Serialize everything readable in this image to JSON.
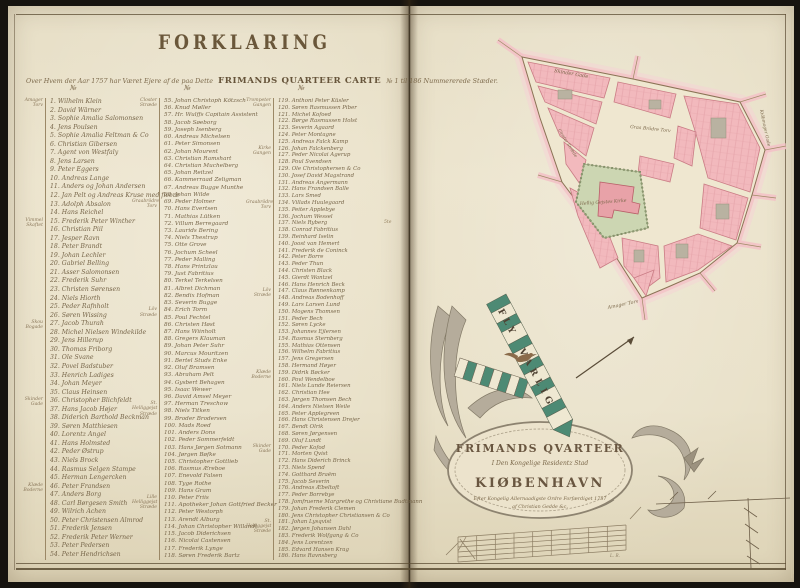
{
  "page": {
    "title": "FORKLARING",
    "subtitle_pre": "Over Hvem der Aar 1757 har Været Ejere af de paa Dette",
    "subtitle_caps": "FRIMANDS QUARTEER CARTE",
    "subtitle_post": "№ 1 til 186 Nummererede Stæder.",
    "gutter_note": "5te"
  },
  "legend": {
    "col_header": "№",
    "columns": [
      {
        "groups": [
          {
            "label": "Amager Torv",
            "start": 1
          },
          {
            "label": "Vimmel Skaftet",
            "start": 15
          },
          {
            "label": "Skou Bogade",
            "start": 27
          },
          {
            "label": "Skinder Gade",
            "start": 36
          },
          {
            "label": "Klæde Boderne",
            "start": 46
          }
        ],
        "entries": [
          {
            "no": 1,
            "name": "Wilhelm Klein"
          },
          {
            "no": 2,
            "name": "David Wärner"
          },
          {
            "no": 3,
            "name": "Sophie Amalia Salomonsen"
          },
          {
            "no": 4,
            "name": "Jens Poulsen"
          },
          {
            "no": 5,
            "name": "Sophie Amalia Feltman & Co"
          },
          {
            "no": 6,
            "name": "Christian Gibersen"
          },
          {
            "no": 7,
            "name": "Agent von Westfaly"
          },
          {
            "no": 8,
            "name": "Jens Larsen"
          },
          {
            "no": 9,
            "name": "Peter Eggers"
          },
          {
            "no": 10,
            "name": "Andreas Lange"
          },
          {
            "no": 11,
            "name": "Anders og Johan Andersen"
          },
          {
            "no": 12,
            "name": "Jan Pelt og Andreas Kruse med fleere"
          },
          {
            "no": 13,
            "name": "Adolph Absalon"
          },
          {
            "no": 14,
            "name": "Hans Reichel"
          },
          {
            "no": 15,
            "name": "Frederik Peter Winther"
          },
          {
            "no": 16,
            "name": "Christian Piil"
          },
          {
            "no": 17,
            "name": "Jesper Ravn"
          },
          {
            "no": 18,
            "name": "Peter Brandt"
          },
          {
            "no": 19,
            "name": "Johan Lechler"
          },
          {
            "no": 20,
            "name": "Gabriel Belling"
          },
          {
            "no": 21,
            "name": "Asser Salomonsen"
          },
          {
            "no": 22,
            "name": "Frederik Suhr"
          },
          {
            "no": 23,
            "name": "Christen Sørensen"
          },
          {
            "no": 24,
            "name": "Niels Hiorth"
          },
          {
            "no": 25,
            "name": "Peder Rafnholt"
          },
          {
            "no": 26,
            "name": "Søren Wissing"
          },
          {
            "no": 27,
            "name": "Jacob Thurah"
          },
          {
            "no": 28,
            "name": "Michel Nielsen Windekilde"
          },
          {
            "no": 29,
            "name": "Jens Hillerup"
          },
          {
            "no": 30,
            "name": "Thomas Friborg"
          },
          {
            "no": 31,
            "name": "Ole Svane"
          },
          {
            "no": 32,
            "name": "Povel Badstuber"
          },
          {
            "no": 33,
            "name": "Henrich Ladiges"
          },
          {
            "no": 34,
            "name": "Johan Meyer"
          },
          {
            "no": 35,
            "name": "Claus Heinsen"
          },
          {
            "no": 36,
            "name": "Christopher Blichfeldt"
          },
          {
            "no": 37,
            "name": "Hans Jacob Højer"
          },
          {
            "no": 38,
            "name": "Diderich Barthold Beckman"
          },
          {
            "no": 39,
            "name": "Søren Matthiesen"
          },
          {
            "no": 40,
            "name": "Lorentz Angel"
          },
          {
            "no": 41,
            "name": "Hans Holmsted"
          },
          {
            "no": 42,
            "name": "Peder Østrup"
          },
          {
            "no": 43,
            "name": "Niels Brock"
          },
          {
            "no": 44,
            "name": "Rasmus Selgen Stampe"
          },
          {
            "no": 45,
            "name": "Herman Lengercken"
          },
          {
            "no": 46,
            "name": "Peter Frandsen"
          },
          {
            "no": 47,
            "name": "Anders Borg"
          },
          {
            "no": 48,
            "name": "Carl Børgesen Smith"
          },
          {
            "no": 49,
            "name": "Wilrich Achen"
          },
          {
            "no": 50,
            "name": "Peter Christensen Almrod"
          },
          {
            "no": 51,
            "name": "Frederik Jensen"
          },
          {
            "no": 52,
            "name": "Frederik Peter Werner"
          },
          {
            "no": 53,
            "name": "Peter Pedersen"
          },
          {
            "no": 54,
            "name": "Peter Hendrichsen"
          }
        ]
      },
      {
        "groups": [
          {
            "label": "Closter Stræde",
            "start": 55
          },
          {
            "label": "Graabrödre Torv",
            "start": 69
          },
          {
            "label": "Löv Stræde",
            "start": 84
          },
          {
            "label": "St. Helliggejst Stræde",
            "start": 97
          },
          {
            "label": "Lille Helliggejst Stræde",
            "start": 110
          }
        ],
        "entries": [
          {
            "no": 55,
            "name": "Johan Christoph Kötzsch"
          },
          {
            "no": 56,
            "name": "Knud Møller"
          },
          {
            "no": 57,
            "name": "Hr. Wulffs Capitain Assistent"
          },
          {
            "no": 58,
            "name": "Jacob Søeborg"
          },
          {
            "no": 59,
            "name": "Joseph Isenberg"
          },
          {
            "no": 60,
            "name": "Andreas Michelsen"
          },
          {
            "no": 61,
            "name": "Peter Simonsen"
          },
          {
            "no": 62,
            "name": "Johan Mourent"
          },
          {
            "no": 63,
            "name": "Christian Ramshart"
          },
          {
            "no": 64,
            "name": "Christian Muchelberg"
          },
          {
            "no": 65,
            "name": "Johan Reitzel"
          },
          {
            "no": 66,
            "name": "Kammerraad Zeligman"
          },
          {
            "no": 67,
            "name": "Andreas Bugge Munthe"
          },
          {
            "no": 68,
            "name": "Johan Wilde"
          },
          {
            "no": 69,
            "name": "Peder Holmer"
          },
          {
            "no": 70,
            "name": "Hans Evertsen"
          },
          {
            "no": 71,
            "name": "Mathias Lütken"
          },
          {
            "no": 72,
            "name": "Villum Berregaard"
          },
          {
            "no": 73,
            "name": "Laurids Bering"
          },
          {
            "no": 74,
            "name": "Niels Thestrup"
          },
          {
            "no": 75,
            "name": "Otte Grove"
          },
          {
            "no": 76,
            "name": "Jochum Scheel"
          },
          {
            "no": 77,
            "name": "Peder Malling"
          },
          {
            "no": 78,
            "name": "Hans Printzlau"
          },
          {
            "no": 79,
            "name": "Just Fabritius"
          },
          {
            "no": 80,
            "name": "Terkel Terkelsen"
          },
          {
            "no": 81,
            "name": "Albret Dichman"
          },
          {
            "no": 82,
            "name": "Bendix Hofman"
          },
          {
            "no": 83,
            "name": "Severin Bugge"
          },
          {
            "no": 84,
            "name": "Erich Torm"
          },
          {
            "no": 85,
            "name": "Poul Fechtel"
          },
          {
            "no": 86,
            "name": "Christen Høst"
          },
          {
            "no": 87,
            "name": "Hans Wiinholt"
          },
          {
            "no": 88,
            "name": "Gregers Klauman"
          },
          {
            "no": 89,
            "name": "Johan Peter Suhr"
          },
          {
            "no": 90,
            "name": "Marcus Mouritzen"
          },
          {
            "no": 91,
            "name": "Bertel Studs Enke"
          },
          {
            "no": 92,
            "name": "Oluf Bramsen"
          },
          {
            "no": 93,
            "name": "Abraham Pelt"
          },
          {
            "no": 94,
            "name": "Gysbert Behagen"
          },
          {
            "no": 95,
            "name": "Isaac Wewer"
          },
          {
            "no": 96,
            "name": "David Amsel Meyer"
          },
          {
            "no": 97,
            "name": "Herman Treschow"
          },
          {
            "no": 98,
            "name": "Niels Titken"
          },
          {
            "no": 99,
            "name": "Broder Brodersen"
          },
          {
            "no": 100,
            "name": "Mads Roed"
          },
          {
            "no": 101,
            "name": "Anders Dons"
          },
          {
            "no": 102,
            "name": "Peder Sommerfeldt"
          },
          {
            "no": 103,
            "name": "Hans Jørgen Sotmann"
          },
          {
            "no": 104,
            "name": "Jørgen Bøfke"
          },
          {
            "no": 105,
            "name": "Christopher Gottlieb"
          },
          {
            "no": 106,
            "name": "Rasmus Æreboe"
          },
          {
            "no": 107,
            "name": "Enevold Falsen"
          },
          {
            "no": 108,
            "name": "Tyge Rothe"
          },
          {
            "no": 109,
            "name": "Hans Gram"
          },
          {
            "no": 110,
            "name": "Peter Friis"
          },
          {
            "no": 111,
            "name": "Apotheker Johan Gottfried Becker"
          },
          {
            "no": 112,
            "name": "Peter Westorph"
          },
          {
            "no": 113,
            "name": "Arendt Alburg"
          },
          {
            "no": 114,
            "name": "Johan Christopher Willandt"
          },
          {
            "no": 115,
            "name": "Jacob Diderichsen"
          },
          {
            "no": 116,
            "name": "Nicolai Castensen"
          },
          {
            "no": 117,
            "name": "Frederik Lynge"
          },
          {
            "no": 118,
            "name": "Søren Frederik Bartz"
          }
        ]
      },
      {
        "groups": [
          {
            "label": "Trompeter Gangen",
            "start": 119
          },
          {
            "label": "Kirke Gangen",
            "start": 126
          },
          {
            "label": "Graabrödre Torv",
            "start": 134
          },
          {
            "label": "Löv Stræde",
            "start": 147
          },
          {
            "label": "Klæde Boderne",
            "start": 159
          },
          {
            "label": "Skinder Gade",
            "start": 170
          },
          {
            "label": "St. Helliggejst Stræde",
            "start": 181
          }
        ],
        "entries": [
          {
            "no": 119,
            "name": "Anthoni Peter Küsler"
          },
          {
            "no": 120,
            "name": "Søren Rasmussen Piber"
          },
          {
            "no": 121,
            "name": "Michel Kofoed"
          },
          {
            "no": 122,
            "name": "Børge Rasmussen Holst"
          },
          {
            "no": 123,
            "name": "Severin Agaard"
          },
          {
            "no": 124,
            "name": "Peter Montagne"
          },
          {
            "no": 125,
            "name": "Andreas Falck Kamp"
          },
          {
            "no": 126,
            "name": "Johan Falckenberg"
          },
          {
            "no": 127,
            "name": "Peder Nicolai Agerup"
          },
          {
            "no": 128,
            "name": "Poul Svendsen"
          },
          {
            "no": 129,
            "name": "Ole Christophersen & Co"
          },
          {
            "no": 130,
            "name": "Josef David Magstrand"
          },
          {
            "no": 131,
            "name": "Andreas Angermann"
          },
          {
            "no": 132,
            "name": "Hans Frandsen Balle"
          },
          {
            "no": 133,
            "name": "Lars Smed"
          },
          {
            "no": 134,
            "name": "Villads Huulegaard"
          },
          {
            "no": 135,
            "name": "Peiter Applebye"
          },
          {
            "no": 136,
            "name": "Jochum Wessel"
          },
          {
            "no": 137,
            "name": "Niels Ryberg"
          },
          {
            "no": 138,
            "name": "Conrad Fabritius"
          },
          {
            "no": 139,
            "name": "Reinhard Iselin"
          },
          {
            "no": 140,
            "name": "Joost van Hemert"
          },
          {
            "no": 141,
            "name": "Frederik de Coninck"
          },
          {
            "no": 142,
            "name": "Peter Borre"
          },
          {
            "no": 143,
            "name": "Peder Thun"
          },
          {
            "no": 144,
            "name": "Christen Black"
          },
          {
            "no": 145,
            "name": "Gierdt Wantzel"
          },
          {
            "no": 146,
            "name": "Hans Henrich Beck"
          },
          {
            "no": 147,
            "name": "Claus Rønnenkamp"
          },
          {
            "no": 148,
            "name": "Andreas Bodenhoff"
          },
          {
            "no": 149,
            "name": "Lars Larsen Lund"
          },
          {
            "no": 150,
            "name": "Mogens Thomsen"
          },
          {
            "no": 151,
            "name": "Peder Bech"
          },
          {
            "no": 152,
            "name": "Søren Lycke"
          },
          {
            "no": 153,
            "name": "Johannes Ejlersen"
          },
          {
            "no": 154,
            "name": "Rasmus Sternberg"
          },
          {
            "no": 155,
            "name": "Mathias Ottensen"
          },
          {
            "no": 156,
            "name": "Wilhelm Fabritius"
          },
          {
            "no": 157,
            "name": "Jens Gregersen"
          },
          {
            "no": 158,
            "name": "Hermand Høyer"
          },
          {
            "no": 159,
            "name": "Didrik Bøcker"
          },
          {
            "no": 160,
            "name": "Povl Wendelboe"
          },
          {
            "no": 161,
            "name": "Niels Lunde Reiersen"
          },
          {
            "no": 162,
            "name": "Christian Hee"
          },
          {
            "no": 163,
            "name": "Jørgen Thomsen Bech"
          },
          {
            "no": 164,
            "name": "Anders Nielsen Weile"
          },
          {
            "no": 165,
            "name": "Peter Applegreen"
          },
          {
            "no": 166,
            "name": "Hans Christensen Drejer"
          },
          {
            "no": 167,
            "name": "Bendt Olrik"
          },
          {
            "no": 168,
            "name": "Søren Jørgensen"
          },
          {
            "no": 169,
            "name": "Oluf Lundt"
          },
          {
            "no": 170,
            "name": "Peder Kofod"
          },
          {
            "no": 171,
            "name": "Morten Qvist"
          },
          {
            "no": 172,
            "name": "Hans Diderich Brinck"
          },
          {
            "no": 173,
            "name": "Niels Spend"
          },
          {
            "no": 174,
            "name": "Gotthard Braëm"
          },
          {
            "no": 175,
            "name": "Jacob Severin"
          },
          {
            "no": 176,
            "name": "Andreas Æbeltoft"
          },
          {
            "no": 177,
            "name": "Peder Borrebye"
          },
          {
            "no": 178,
            "name": "Jomfruerne Margrethe og Christiane Budtmann"
          },
          {
            "no": 179,
            "name": "Johan Frederik Clemen"
          },
          {
            "no": 180,
            "name": "Jens Christopher Christiansen & Co"
          },
          {
            "no": 181,
            "name": "Johan Lysqvist"
          },
          {
            "no": 182,
            "name": "Jørgen Johansen Dahl"
          },
          {
            "no": 183,
            "name": "Frederik Wolfgang & Co"
          },
          {
            "no": 184,
            "name": "Jens Lorentzen"
          },
          {
            "no": 185,
            "name": "Edvard Hansen Krag"
          },
          {
            "no": 186,
            "name": "Hans Ravnsberg"
          }
        ]
      }
    ]
  },
  "map": {
    "labels": {
      "skindergade": "Skinder Gade",
      "graabroedretorv": "Graa Brödre Torv",
      "kirke": "Hellig Gejstes Kirke",
      "amagertorv": "Amager Torv",
      "kioebmagergade": "Kiöbmager Gade",
      "closterstraede": "Closter Stræde"
    }
  },
  "banner": {
    "word1": "FLY",
    "word2": "VARLIG"
  },
  "cartouche": {
    "line1": "FRIMANDS QVARTEER",
    "line2": "I Den Kongelige Residentz Stad",
    "line3": "KIØBENHAVN",
    "line4": "Efter Kongelig Allernaadigste Ordre Forfærdiget 1757",
    "line5": "af Christian Gedde &c.",
    "scale_mark": "L. R."
  },
  "colors": {
    "parchment": "#e9e1c9",
    "ink": "#6e5b3f",
    "map_block_pink": "#f2b9bd",
    "map_outline_red": "#c97b84",
    "churchyard_green": "#ccd6b2",
    "banner_green": "#4d8a74"
  }
}
